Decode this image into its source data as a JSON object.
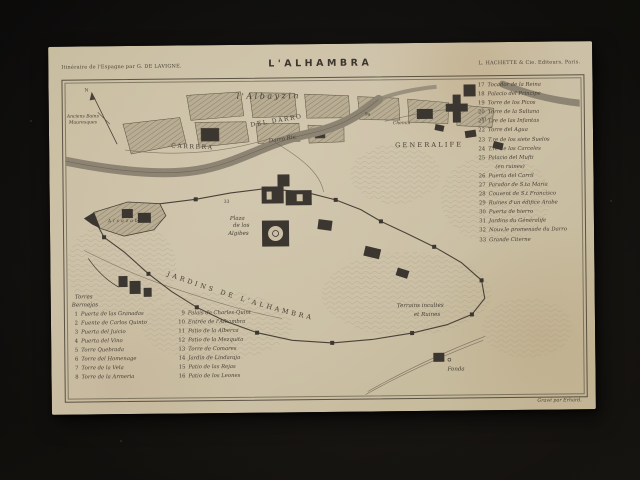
{
  "header": {
    "imprint_left": "Itinéraire de l'Espagne par G. DE LAVIGNE.",
    "title": "L'ALHAMBRA",
    "imprint_right": "L. HACHETTE & Cie. Editeurs, Paris."
  },
  "map": {
    "compass": "N",
    "labels": {
      "albayzin": "l'Albayzin",
      "baths_1": "Anciens Bains",
      "baths_2": "Mauresques",
      "carrera": "CARRERA",
      "del_darro": "DEL  DARRO",
      "river": "Darro Riv.",
      "chemin": "Chemin",
      "generalife": "GENERALIFE",
      "plaza_1": "Plaza",
      "plaza_2": "de los",
      "plaza_3": "Algibes",
      "alcazaba": "Alcazaba",
      "torres_1": "Torres",
      "torres_2": "Bermejas",
      "jardins": "JARDINS  DE  L'ALHAMBRA",
      "terrains_1": "Terrains incultes",
      "terrains_2": "et Ruines",
      "fonda": "Fonda"
    },
    "markers": {
      "m1": "9a",
      "m2": "31",
      "m3": "33"
    },
    "credit": "Gravé par Erhard."
  },
  "legend": {
    "col1": [
      {
        "num": "1",
        "label": "Puerta de las Granadas",
        "note": ""
      },
      {
        "num": "2",
        "label": "Fuente de Carlos Quinto",
        "note": ""
      },
      {
        "num": "3",
        "label": "Puerta del Juicio",
        "note": ""
      },
      {
        "num": "4",
        "label": "Puerta del Vino",
        "note": ""
      },
      {
        "num": "5",
        "label": "Torre Quebrada",
        "note": ""
      },
      {
        "num": "6",
        "label": "Torre del Homenage",
        "note": ""
      },
      {
        "num": "7",
        "label": "Torre de la Vela",
        "note": ""
      },
      {
        "num": "8",
        "label": "Torre de la Armeria",
        "note": ""
      }
    ],
    "col2": [
      {
        "num": "9",
        "label": "Palais de Charles-Quint",
        "note": ""
      },
      {
        "num": "10",
        "label": "Entrée de l'Alhambra",
        "note": ""
      },
      {
        "num": "11",
        "label": "Patio de la Alberca",
        "note": ""
      },
      {
        "num": "12",
        "label": "Patio de la Mezquita",
        "note": ""
      },
      {
        "num": "13",
        "label": "Torre de Comares",
        "note": ""
      },
      {
        "num": "14",
        "label": "Jardin de Lindaraja",
        "note": ""
      },
      {
        "num": "15",
        "label": "Patio de las Rejas",
        "note": ""
      },
      {
        "num": "16",
        "label": "Patio de los Leones",
        "note": ""
      }
    ],
    "col3": [
      {
        "num": "17",
        "label": "Tocador de la Reina",
        "note": ""
      },
      {
        "num": "18",
        "label": "Palacio del Principe",
        "note": ""
      },
      {
        "num": "19",
        "label": "Torre de los Picos",
        "note": ""
      },
      {
        "num": "20",
        "label": "Torre de la Sultana",
        "note": ""
      },
      {
        "num": "21",
        "label": "T.re de las Infantas",
        "note": ""
      },
      {
        "num": "22",
        "label": "Torre del Agua",
        "note": ""
      },
      {
        "num": "23",
        "label": "T.re de los siete Suelos",
        "note": ""
      },
      {
        "num": "24",
        "label": "T.re de las Carceles",
        "note": ""
      },
      {
        "num": "25",
        "label": "Palacio del Mufti",
        "note": "(en ruines)"
      },
      {
        "num": "26",
        "label": "Puerta del Carril",
        "note": ""
      },
      {
        "num": "27",
        "label": "Parador de S.ta Maria",
        "note": ""
      },
      {
        "num": "28",
        "label": "Couvent de S.t Francisco",
        "note": ""
      },
      {
        "num": "29",
        "label": "Ruines d'un édifice Arabe",
        "note": ""
      },
      {
        "num": "30",
        "label": "Puerta de hierro",
        "note": ""
      },
      {
        "num": "31",
        "label": "Jardins du Généralife",
        "note": ""
      },
      {
        "num": "32",
        "label": "Nouv.le promenade du Darro",
        "note": ""
      },
      {
        "num": "33",
        "label": "Grande Citerne",
        "note": ""
      }
    ]
  }
}
